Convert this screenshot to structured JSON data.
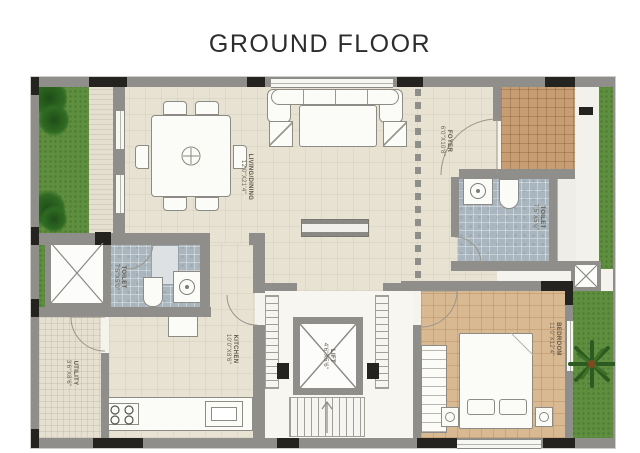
{
  "title": "GROUND FLOOR",
  "plan": {
    "rooms": {
      "living_dining": {
        "label": "LIVING/DINING",
        "dim": "12'0\"X21'4\""
      },
      "foyer": {
        "label": "FOYER",
        "dim": "6'0\"X10'8\""
      },
      "toilet_right": {
        "label": "TOILET",
        "dim": "7'5\"X5'0\""
      },
      "toilet_left": {
        "label": "TOILET",
        "dim": "7'5\"X5'0\""
      },
      "kitchen": {
        "label": "KITCHEN",
        "dim": "10'0\"X8'6\""
      },
      "utility": {
        "label": "UTILITY",
        "dim": "3'6\"X8'6\""
      },
      "lift": {
        "label": "LIFT",
        "dim": "4'6\"X5'6\""
      },
      "bedroom": {
        "label": "BEDROOM",
        "dim": "11'0\"X12'4\""
      }
    },
    "colors": {
      "wall": "#8f8e8a",
      "column": "#24231f",
      "floor_beige": "#e8e2d2",
      "toilet_tile": "#a9b6bf",
      "bedroom_floor": "#d9b992",
      "porch": "#c79e74",
      "garden": "#5d8f3f",
      "label_text": "#6b6356",
      "title_text": "#2d2d2f"
    }
  }
}
